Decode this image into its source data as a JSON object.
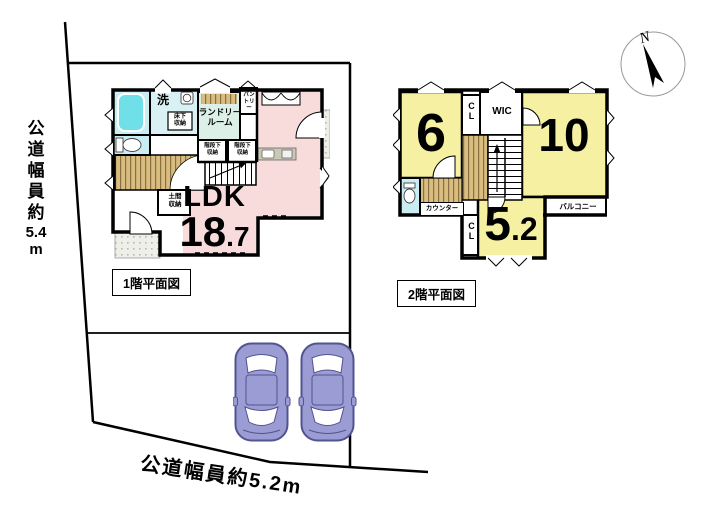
{
  "site": {
    "road_left": {
      "kanji": "公道幅員約",
      "number": "5.4",
      "unit": "m"
    },
    "road_bottom": "公道幅員約5.2m",
    "compass": "N"
  },
  "floor1": {
    "caption": "1階平面図",
    "ldk": {
      "name": "LDK",
      "area_int": "18",
      "area_dec": ".7"
    },
    "labels": {
      "wash": "洗",
      "laundry_1": "ランドリー",
      "laundry_2": "ルーム",
      "pantry_1": "パン",
      "pantry_2": "トリー",
      "underfloor_1": "床下",
      "underfloor_2": "収納",
      "understairs_1": "階段下",
      "understairs_2": "収納",
      "doma_1": "土間",
      "doma_2": "収納"
    }
  },
  "floor2": {
    "caption": "2階平面図",
    "labels": {
      "room6": "6",
      "room10": "10",
      "room52_int": "5",
      "room52_dec": ".2",
      "cl_upper": "CL",
      "cl_lower": "CL",
      "wic": "WIC",
      "counter": "カウンター",
      "balcony": "バルコニー"
    }
  },
  "colors": {
    "ldk_pink": "#f8dcdc",
    "bedroom_yellow": "#f6f0a2",
    "water_cyan": "#c9edf2",
    "bathtub_cyan": "#6fdfe8",
    "wood_tan": "#d9bd80",
    "car_body": "#9b9cd4",
    "car_outline": "#52538f"
  }
}
